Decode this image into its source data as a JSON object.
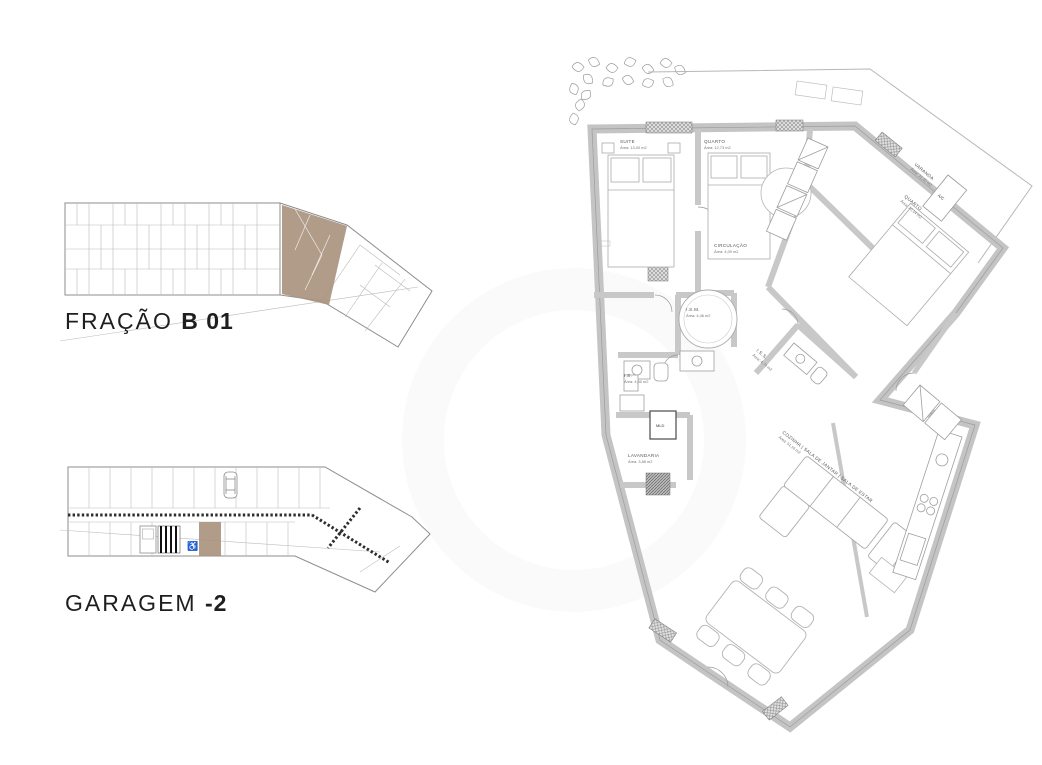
{
  "page": {
    "background": "#ffffff"
  },
  "key_plans": {
    "fracao": {
      "title_regular": "FRAÇÃO",
      "title_bold": "B 01",
      "highlight_color": "#a8917c"
    },
    "garagem": {
      "title_regular": "GARAGEM",
      "title_bold": "-2",
      "highlight_color": "#a8917c",
      "wheelchair_icon": "♿"
    }
  },
  "main_plan": {
    "labels": {
      "suite": {
        "name": "SUITE",
        "area": "Área: 13,00 m2"
      },
      "quarto1": {
        "name": "QUARTO",
        "area": "Área: 12,73 m2"
      },
      "quarto2": {
        "name": "QUARTO",
        "area": "Área: 10,14 m2"
      },
      "circulacao": {
        "name": "CIRCULAÇÃO",
        "area": "Área: 4,09 m2"
      },
      "ism": {
        "name": "I.S.M.",
        "area": "Área: 4,46 m2"
      },
      "is": {
        "name": "I.S.",
        "area": "Área: 4,50 m2"
      },
      "iss": {
        "name": "I.S.S.",
        "area": "Área: 4,70 m2"
      },
      "lavandaria": {
        "name": "LAVANDARIA",
        "area": "Área: 3,88 m2"
      },
      "varanda": {
        "name": "VARANDA",
        "area": "Área: 21,20 m2"
      },
      "living": {
        "name": "COZINHA | SALA DE JANTAR | SALA DE ESTAR",
        "area": "Área: 51,16 m2"
      },
      "ac": {
        "name": "A/C"
      },
      "mld": {
        "name": "MLD"
      }
    }
  }
}
